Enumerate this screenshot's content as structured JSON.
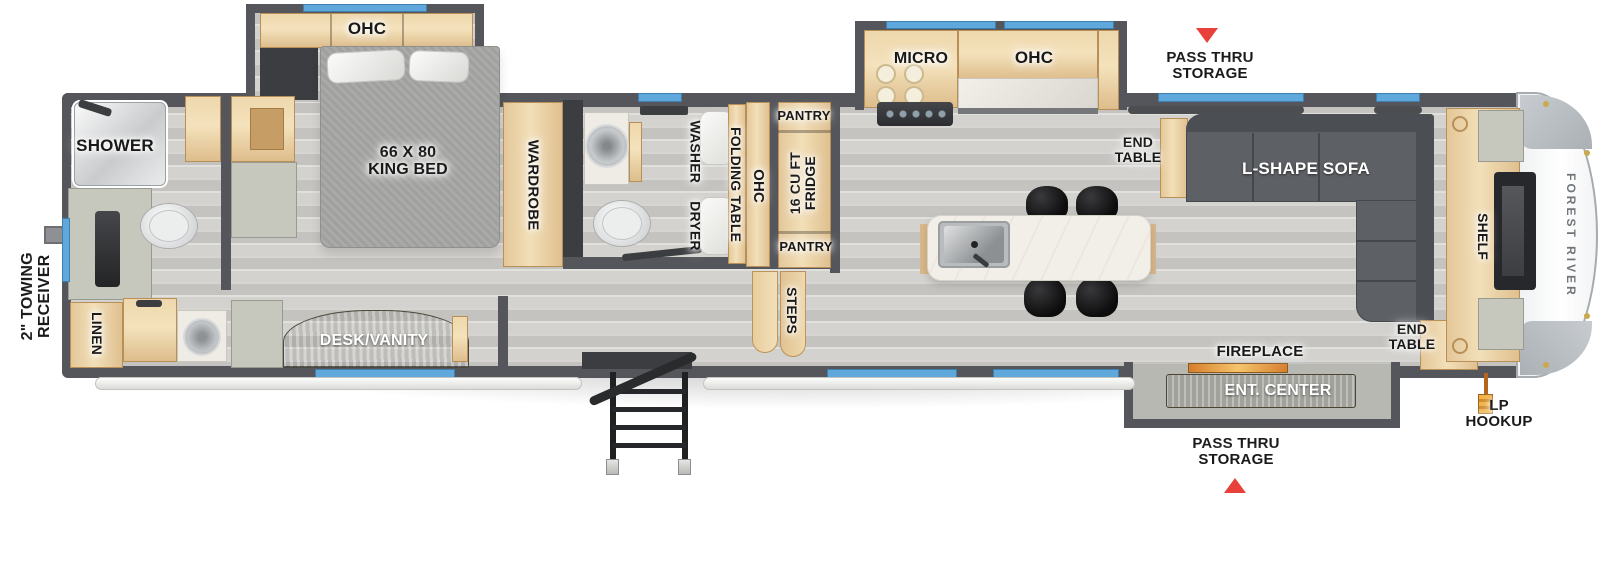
{
  "floorplan": {
    "exterior": {
      "towing_receiver": "2\" TOWING\nRECEIVER",
      "pass_thru_top": "PASS THRU\nSTORAGE",
      "pass_thru_bottom": "PASS THRU\nSTORAGE",
      "lp_hookup": "LP\nHOOKUP",
      "brand": "FOREST RIVER"
    },
    "rear_bath": {
      "shower": "SHOWER",
      "linen": "LINEN"
    },
    "bedroom": {
      "ohc": "OHC",
      "bed": "66 X 80\nKING BED",
      "wardrobe": "WARDROBE",
      "desk": "DESK/VANITY"
    },
    "mid_bath": {
      "washer_dryer": "WASHER DRYER",
      "folding_table": "FOLDING TABLE",
      "ohc": "OHC"
    },
    "kitchen": {
      "pantry_top": "PANTRY",
      "fridge": "16 CU FT\nFRIDGE",
      "pantry_bottom": "PANTRY",
      "steps": "STEPS",
      "micro": "MICRO",
      "ohc": "OHC"
    },
    "living": {
      "end_table_top": "END\nTABLE",
      "sofa": "L-SHAPE SOFA",
      "shelf": "SHELF",
      "end_table_bottom": "END\nTABLE",
      "fireplace": "FIREPLACE",
      "ent_center": "ENT. CENTER"
    },
    "colors": {
      "wall": "#54565b",
      "wood": "#ecd3a5",
      "window_blue": "#5fa8dc",
      "arrow_red": "#e8403a",
      "sofa_gray": "#5d6064",
      "floor_gray": "#cccbc7",
      "marble": "#efece5",
      "lp_orange": "#e09126"
    }
  }
}
